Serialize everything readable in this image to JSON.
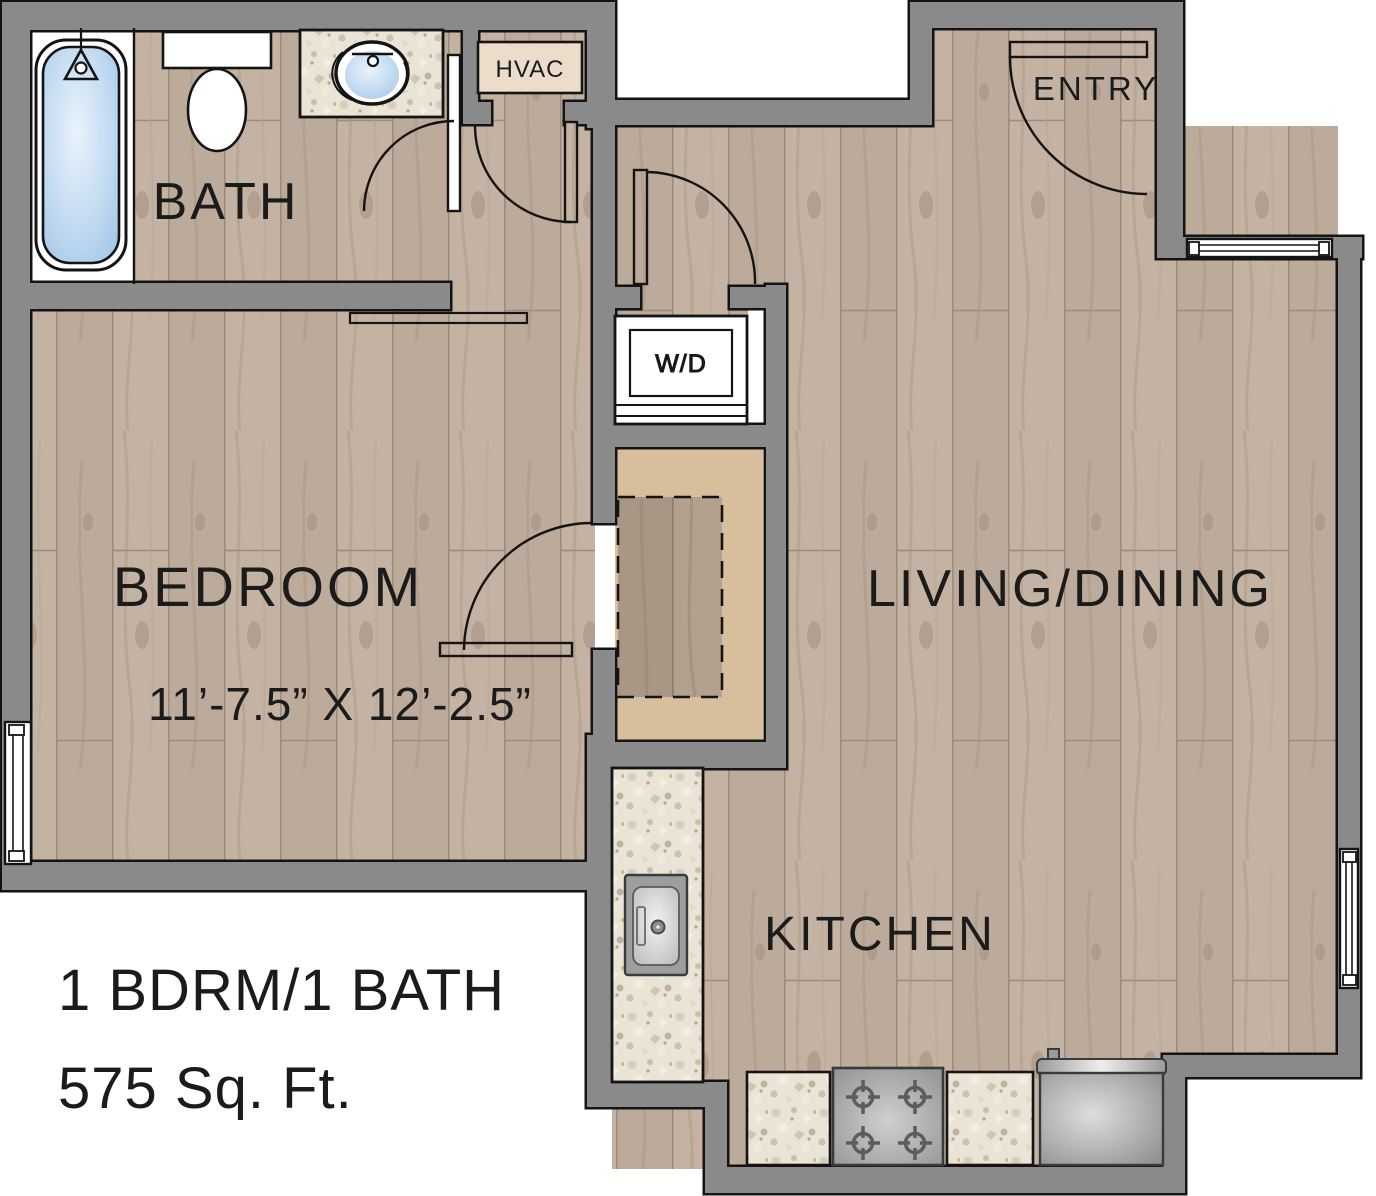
{
  "plan": {
    "title": "1 BDRM/1 BATH 575 Sq. Ft. floor plan",
    "footer": {
      "line1": "1 BDRM/1 BATH",
      "line2": "575 Sq. Ft."
    },
    "rooms": {
      "bath": {
        "label": "BATH"
      },
      "hvac": {
        "label": "HVAC"
      },
      "entry": {
        "label": "ENTRY"
      },
      "wd": {
        "label": "W/D"
      },
      "bedroom": {
        "label": "BEDROOM",
        "dimensions": "11’-7.5” X 12’-2.5”"
      },
      "living": {
        "label": "LIVING/DINING"
      },
      "kitchen": {
        "label": "KITCHEN"
      }
    },
    "fixtures": [
      "bathtub",
      "shower-head",
      "toilet",
      "bathroom-sink",
      "vanity-counter",
      "washer-dryer",
      "closet-rod",
      "kitchen-sink",
      "kitchen-counter",
      "stove",
      "refrigerator"
    ],
    "doors": [
      "bath-door",
      "hvac-door",
      "corridor-door",
      "bedroom-door",
      "entry-door"
    ],
    "windows": [
      "bedroom-window-west",
      "living-window-north",
      "living-window-east"
    ],
    "colors": {
      "wall": "#8a8a8a",
      "outline": "#141414",
      "wood": "#c2b1a1",
      "wood_dark": "#ae9b89",
      "granite": "#eae4d6",
      "closet_tan": "#d7bf9e",
      "water_blue": "#b7d5ef",
      "appliance_gray": "#a6a6a6"
    }
  }
}
